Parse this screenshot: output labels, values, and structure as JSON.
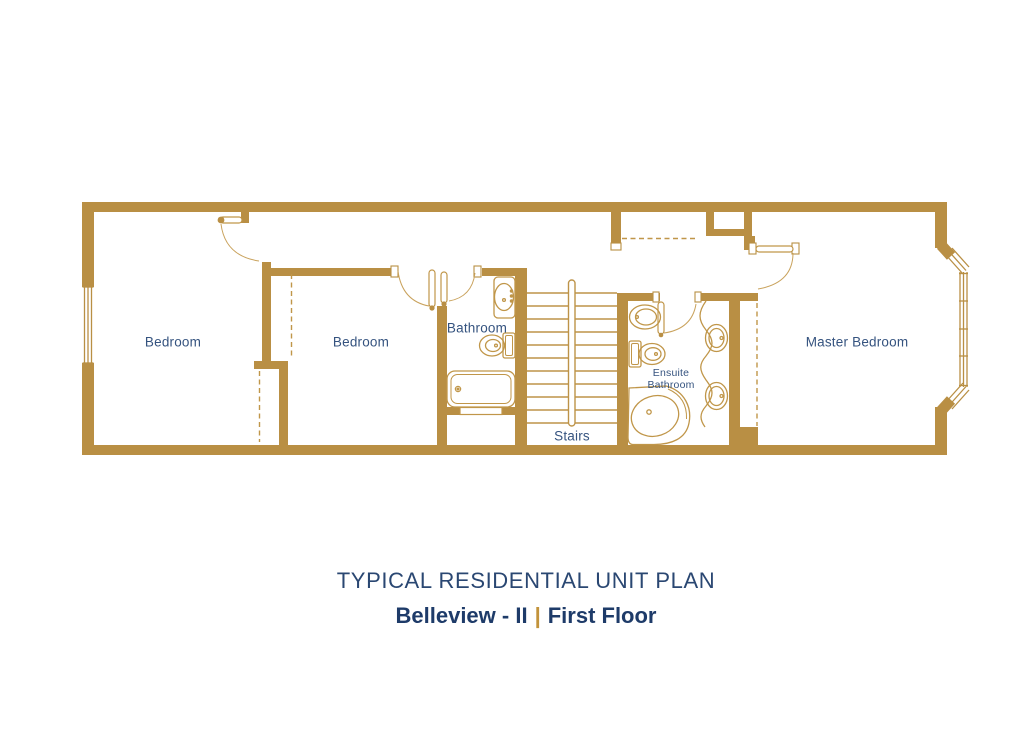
{
  "plan": {
    "rooms": {
      "bedroom1": {
        "label": "Bedroom"
      },
      "bedroom2": {
        "label": "Bedroom"
      },
      "bathroom": {
        "label": "Bathroom"
      },
      "stairs": {
        "label": "Stairs"
      },
      "ensuite": {
        "line1": "Ensuite",
        "line2": "Bathroom"
      },
      "master": {
        "label": "Master Bedroom"
      }
    },
    "features": [
      "bay-window",
      "left-window",
      "stair-rail",
      "wardrobe-dashed-lines",
      "bathtub",
      "corner-bathtub",
      "toilets",
      "sinks",
      "vanity-double-sink",
      "door-swings"
    ]
  },
  "footer": {
    "title": "TYPICAL RESIDENTIAL UNIT PLAN",
    "project": "Belleview - II",
    "separator": "|",
    "floor": "First Floor"
  },
  "colors": {
    "wall_gold": "#b98f44",
    "fixture_gold": "#c09649",
    "room_label_navy": "#35537f",
    "title_navy": "#2a4772",
    "subtitle_navy": "#1e3b69",
    "separator_gold": "#c2933b"
  }
}
